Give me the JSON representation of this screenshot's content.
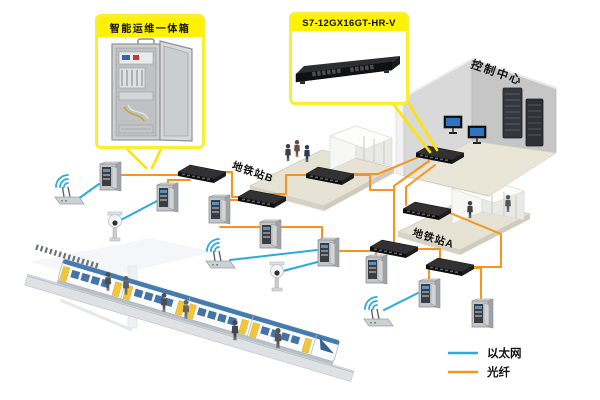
{
  "callouts": {
    "cabinet": {
      "label": "智能运维一体箱"
    },
    "switch": {
      "label": "S7-12GX16GT-HR-V"
    }
  },
  "locations": {
    "control_center": {
      "label": "控制中心"
    },
    "station_b": {
      "label": "地铁站B"
    },
    "station_a": {
      "label": "地铁站A"
    }
  },
  "legend": {
    "items": [
      {
        "id": "ethernet",
        "label": "以太网",
        "color": "#29abe2"
      },
      {
        "id": "fiber",
        "label": "光纤",
        "color": "#f7941e"
      }
    ]
  },
  "colors": {
    "ethernet": "#29abe2",
    "fiber": "#f7941e",
    "callout_fill": "#fff100",
    "callout_border": "#f9ee30",
    "leader": "#ffe400"
  },
  "icons": {
    "wall_cabinet": "wall-mount-cabinet-icon",
    "rack_switch": "rack-switch-icon",
    "fiber_switch": "fiber-switch-icon",
    "wifi_ap": "wifi-access-point-icon",
    "ptz_camera": "ptz-camera-icon",
    "monitor": "monitor-icon",
    "server_rack": "server-rack-icon",
    "metro_train": "metro-train-icon"
  }
}
